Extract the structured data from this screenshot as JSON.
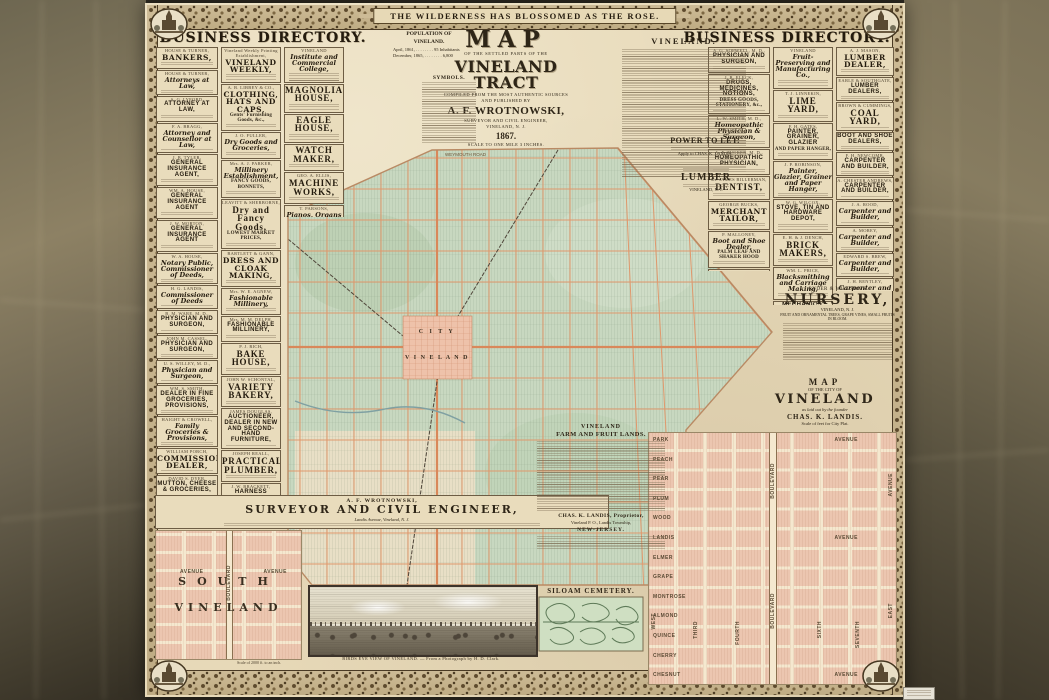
{
  "colors": {
    "parchment": "#e7d9b8",
    "map_green": "#c8d8c0",
    "road_orange": "#e0986c",
    "plat_pink": "#ecc6b0",
    "frame_brown": "#5d4a2d",
    "background": "#6b6350"
  },
  "poster": {
    "banner": "THE WILDERNESS HAS BLOSSOMED AS THE ROSE.",
    "left_header": "BUSINESS DIRECTORY.",
    "right_header": "BUSINESS DIRECTORY."
  },
  "title_block": {
    "t1": "MAP",
    "t2": "OF THE SETTLED PARTS OF THE",
    "t3": "VINELAND TRACT",
    "t4": "COMPILED FROM THE MOST AUTHENTIC SOURCES",
    "t5": "AND PUBLISHED BY",
    "t6": "A. F. WROTNOWSKI,",
    "t7": "SURVEYOR AND CIVIL ENGINEER,",
    "t8": "VINELAND, N. J.",
    "t9": "1867.",
    "t10": "SCALE TO ONE MILE 3 INCHES."
  },
  "population": {
    "head": "POPULATION OF VINELAND.",
    "line1": "April, 1861, . . . . . . . .  95 Inhabitants",
    "line2": "December, 1865, . . . . . . . .  6,800"
  },
  "symbols_head": "SYMBOLS.",
  "article_head": "VINELAND.",
  "power": {
    "head": "POWER TO LET.",
    "apply": "Apply to CHAS. K. LANDIS."
  },
  "lumber": {
    "head": "LUMBER",
    "place": "VINELAND, N. J."
  },
  "map_labels": {
    "road": "WEYMOUTH ROAD",
    "city1": "C I T Y",
    "city2": "V I N E L A N D"
  },
  "nursery": {
    "n": "RYDER & WILLSON'S",
    "h": "NURSERY,",
    "place": "VINELAND, N. J.",
    "line": "FRUIT AND ORNAMENTAL TREES, GRAPE VINES, SMALL FRUITS IN BLOOM."
  },
  "city_title": {
    "l1": "MAP",
    "l2": "OF THE CITY OF",
    "l3": "VINELAND",
    "l4": "as laid out by the founder",
    "l5": "CHAS. K. LANDIS.",
    "l6": "Scale of feet for City Plat."
  },
  "city_plat": {
    "cross_streets": [
      "PARK",
      "PEACH",
      "PEAR",
      "PLUM",
      "WOOD",
      "LANDIS",
      "ELMER",
      "GRAPE",
      "MONTROSE",
      "ALMOND",
      "QUINCE",
      "CHERRY",
      "CHESNUT"
    ],
    "avenue_word": "AVENUE",
    "numbered_streets": [
      "THIRD",
      "FOURTH",
      "SIXTH",
      "SEVENTH"
    ],
    "west": "WEST",
    "east": "EAST",
    "boulevard": "BOULEVARD",
    "avenue_vert": "AVENUE"
  },
  "surveyor": {
    "n": "A. F. WROTNOWSKI,",
    "h": "SURVEYOR AND CIVIL ENGINEER,",
    "line": "Landis Avenue, Vineland, N. J."
  },
  "south": {
    "big1": "SOUTH",
    "big2": "VINELAND",
    "boulevard": "BOULEVARD",
    "avenue": "AVENUE",
    "scale": "Scale of 2000 ft. to an inch."
  },
  "farm": {
    "h1": "VINELAND",
    "h2": "FARM AND FRUIT LANDS.",
    "p1": "CHAS. K. LANDIS, Proprietor,",
    "p2": "Vineland P. O., Landis Township,",
    "p3": "NEW-JERSEY."
  },
  "cemetery_head": "SILOAM CEMETERY.",
  "birdseye_caption": "BIRDS EYE VIEW OF VINELAND. — From a Photograph by H. D. Clark.",
  "directories": {
    "lcol1": [
      {
        "n": "HOUSE & TURNER,",
        "h": "BANKERS,",
        "v": 3,
        "s": 2
      },
      {
        "n": "HOUSE & TURNER,",
        "h": "Attorneys at Law,",
        "v": 2,
        "s": 1
      },
      {
        "n": "A. G. LYFORD,",
        "h": "ATTORNEY AT LAW,",
        "v": 5,
        "s": 2
      },
      {
        "n": "F. A. BRAGG,",
        "h": "Attorney and Counsellor at Law,",
        "v": 2,
        "s": 1
      },
      {
        "n": "J. B. TYLER,",
        "h": "GENERAL INSURANCE AGENT,",
        "v": 5,
        "s": 2
      },
      {
        "n": "WM. A. HOUSE,",
        "h": "GENERAL INSURANCE AGENT",
        "v": 5,
        "s": 2
      },
      {
        "n": "J. W. MORTON,",
        "h": "GENERAL INSURANCE AGENT",
        "v": 5,
        "s": 2
      },
      {
        "n": "W. A. HOUSE,",
        "h": "Notary Public, Commissioner of Deeds,",
        "v": 2,
        "s": 1
      },
      {
        "n": "H. G. LANDIS,",
        "h": "Commissioner of Deeds",
        "v": 2,
        "s": 1
      },
      {
        "n": "B. M. WARE, M. D.,",
        "h": "PHYSICIAN AND SURGEON,",
        "v": 5,
        "s": 1
      },
      {
        "n": "JOHN M. CASSEL,",
        "h": "PHYSICIAN AND SURGEON,",
        "v": 5,
        "s": 1
      },
      {
        "n": "U. S. WILLEY, M. D.,",
        "h": "Physician and Surgeon,",
        "v": 2,
        "s": 1
      },
      {
        "n": "WM. S. SMITH,",
        "h": "DEALER IN FINE GROCERIES, PROVISIONS,",
        "v": 5,
        "s": 1
      },
      {
        "n": "HAIGHT & CROWELL,",
        "h": "Family Groceries & Provisions,",
        "v": 2,
        "s": 1
      },
      {
        "n": "WILLIAM PORCH,",
        "h": "COMMISSION DEALER,",
        "v": 3,
        "s": 1
      },
      {
        "n": "DAVID S. DYER,",
        "h": "MUTTON, CHEESE & GROCERIES,",
        "v": 5,
        "s": 1
      },
      {
        "n": "BACHELDER & DYER,",
        "h": "CHOICE GROCERIES AND PROVISIONS,",
        "v": 5,
        "s": 1
      },
      {
        "n": "LELAND & PARSONS,",
        "h": "MECHANICS' HALL MARKET,",
        "v": 3,
        "s": 1
      },
      {
        "n": "H. H. SIMON,",
        "h": "GROCERIES, PRODUCE,",
        "h2": "AND PROVISIONS,",
        "v": 3,
        "s": 1
      },
      {
        "n": "ERIC A. SMITH,",
        "h": "Dry Goods, Groceries,",
        "v": 2,
        "s": 1
      },
      {
        "n": "HERBERT A. SMITH,",
        "h": "DRY GOODS, PROVISIONS,",
        "v": 5,
        "s": 1
      },
      {
        "n": "PEARSON B. STONE,",
        "h": "PURE CLARIFIED CIDER VINEGAR,",
        "v": 5,
        "s": 1
      },
      {
        "n": "G. W. BABCOCK,",
        "h": "WATCHES, CLOCKS AND JEWELRY,",
        "v": 5,
        "s": 1
      },
      {
        "n": "SMITH & REEVE,",
        "h": "MANUFACTURERS OF CIGARS,",
        "v": 5,
        "s": 1
      }
    ],
    "lcol2": [
      {
        "n": "Vineland Weekly Printing Establishment,",
        "h": "VINELAND WEEKLY,",
        "v": 3,
        "s": 3
      },
      {
        "n": "A. B. LIBBEY & CO.,",
        "h": "CLOTHING, HATS AND CAPS,",
        "h2": "Gents' Furnishing Goods, &c.,",
        "v": 3,
        "s": 2
      },
      {
        "n": "J. O. FULLER,",
        "h": "Dry Goods and Groceries,",
        "v": 2,
        "s": 2
      },
      {
        "n": "Mrs. A. J. PARKER,",
        "h": "Millinery Establishment,",
        "h2": "FANCY GOODS, BONNETS,",
        "v": 2,
        "s": 2
      },
      {
        "n": "LEAVITT & SHERBORNE,",
        "h": "Dry and Fancy Goods,",
        "h2": "LOWEST MARKET PRICES,",
        "v": 4,
        "s": 2
      },
      {
        "n": "BARTLETT & GANN,",
        "h": "DRESS AND CLOAK MAKING,",
        "v": 3,
        "s": 2
      },
      {
        "n": "Mrs. W. E. AGNEW,",
        "h": "Fashionable Millinery,",
        "v": 2,
        "s": 2
      },
      {
        "n": "Mrs. M. M. DELPH,",
        "h": "FASHIONABLE MILLINERY,",
        "v": 5,
        "s": 2
      },
      {
        "n": "P. J. RICH,",
        "h": "BAKE HOUSE,",
        "v": 4,
        "s": 2
      },
      {
        "n": "JOHN W. SCHONTAL,",
        "h": "VARIETY BAKERY,",
        "v": 4,
        "s": 2
      },
      {
        "n": "JAMES DOUGLAS,",
        "h": "AUCTIONEER, DEALER IN NEW AND SECOND-HAND FURNITURE,",
        "v": 5,
        "s": 1
      },
      {
        "n": "JOSEPH REALL,",
        "h": "PRACTICAL PLUMBER,",
        "v": 4,
        "s": 2
      },
      {
        "n": "J. W. BRACKETT,",
        "h": "HARNESS MAKER & CARRIAGE TRIMMER,",
        "v": 5,
        "s": 1
      },
      {
        "n": "GEORGE S. BARING,",
        "h": "Horse Shoers and Carriage Smiths,",
        "v": 2,
        "s": 1
      },
      {
        "n": "LEWIS EDLIN,",
        "h": "Blacksmith and Carriage Work,",
        "v": 2,
        "s": 1
      },
      {
        "n": "THOMAS SHARP,",
        "h": "WELL DIGGER,",
        "v": 3,
        "s": 1
      },
      {
        "n": "D. E. POAGE,",
        "h": "FURNITURE AND JOB WAGON,",
        "v": 5,
        "s": 1
      },
      {
        "n": "DAVID HITCHNER,",
        "h": "Manufacturer of Rag Carpets,",
        "v": 2,
        "s": 1
      },
      {
        "n": "R. T. CUMMINGS,",
        "h": "Hair Cutting, Dyeing and Shaving,",
        "v": 2,
        "s": 1
      },
      {
        "n": "G. G. BROWNMAN,",
        "h": "BOOKS, STATIONERY, WALL PAPER, WINDOW SHADES, &c.,",
        "v": 5,
        "s": 1
      }
    ],
    "lcol3": [
      {
        "n": "VINELAND",
        "h": "Institute and Commercial College,",
        "v": 2,
        "s": 3
      },
      {
        "h": "MAGNOLIA HOUSE,",
        "v": 4,
        "s": 3
      },
      {
        "h": "EAGLE HOUSE,",
        "v": 4,
        "s": 3
      },
      {
        "h": "WATCH MAKER,",
        "v": 4,
        "s": 2
      },
      {
        "n": "GEO. A. ELLIS,",
        "h": "MACHINE WORKS,",
        "v": 4,
        "s": 2
      },
      {
        "n": "T. PARSONS,",
        "h": "Pianos, Organs and Melodeons,",
        "v": 2,
        "s": 2
      },
      {
        "h": "MERCHANT TAILOR,",
        "v": 3,
        "s": 2
      }
    ],
    "rcol1": [
      {
        "n": "A. G. SOPWELL, M. D.,",
        "h": "PHYSICIAN AND SURGEON,",
        "v": 5,
        "s": 2
      },
      {
        "n": "J. R. ELECK,",
        "h": "DRUGS, MEDICINES, NOTIONS,",
        "h2": "DRESS GOODS, STATIONERY, &c.,",
        "v": 5,
        "s": 1
      },
      {
        "n": "L. W. SMITH, M. D.,",
        "h": "Homeopathic Physician & Surgeon,",
        "v": 2,
        "s": 2
      },
      {
        "n": "A. F. TUCKER, M. D.,",
        "h": "HOMEOPATHIC PHYSICIAN,",
        "v": 5,
        "s": 2
      },
      {
        "n": "Dr. JAMES BILLERMAN,",
        "h": "DENTIST,",
        "v": 4,
        "s": 2
      },
      {
        "n": "GEORGE BUCKS,",
        "h": "MERCHANT TAILOR,",
        "v": 3,
        "s": 2
      },
      {
        "n": "P. MALLONEY,",
        "h": "Boot and Shoe Dealer,",
        "h2": "PALM LEAF AND SHAKER HOOD",
        "v": 2,
        "s": 2
      },
      {
        "n": "H. D. CLARK,",
        "h": "PHOTOGRAPHER,",
        "h2": "Post Office Building,",
        "v": 4,
        "s": 2
      },
      {
        "h": "TOWN TALKS,",
        "v": 5,
        "s": 3
      }
    ],
    "rcol2": [
      {
        "n": "VINELAND",
        "h": "Fruit-Preserving and Manufacturing Co.,",
        "v": 2,
        "s": 3
      },
      {
        "n": "T. J. LINNEKIN,",
        "h": "LIME YARD,",
        "v": 4,
        "s": 2
      },
      {
        "n": "F. H. GATES,",
        "h": "PAINTER, GRAINER, GLAZIER",
        "h2": "AND PAPER HANGER,",
        "v": 5,
        "s": 2
      },
      {
        "n": "J. P. ROBINSON,",
        "h": "Painter, Glazier, Grainer and Paper Hanger,",
        "v": 2,
        "s": 1
      },
      {
        "n": "W. G. WILCOX,",
        "h": "STOVE, TIN AND HARDWARE DEPOT,",
        "v": 5,
        "s": 3
      },
      {
        "n": "E. H. & J. DENCH,",
        "h": "BRICK MAKERS,",
        "v": 4,
        "s": 2
      },
      {
        "n": "WM. L. PRICE,",
        "h": "Blacksmithing and Carriage Making,",
        "v": 2,
        "s": 2
      },
      {
        "h": "MECHANICS' HALL,",
        "v": 5,
        "s": 2
      },
      {
        "n": "GASTON & HANN,",
        "h": "Livery and Sale Stables,",
        "v": 2,
        "s": 2
      },
      {
        "h": "LIVERY, SALE AND EXCHANGE STABLES,",
        "v": 5,
        "s": 1
      }
    ],
    "rcol3": [
      {
        "n": "A. J. MASON,",
        "h": "LUMBER DEALER,",
        "v": 3,
        "s": 2
      },
      {
        "n": "EARLE & SOUTHGATE,",
        "h": "LUMBER DEALERS,",
        "v": 5,
        "s": 1
      },
      {
        "n": "BROWN & CUMMINGS,",
        "h": "COAL YARD,",
        "v": 4,
        "s": 1
      },
      {
        "h": "BOOT AND SHOE DEALERS,",
        "v": 5,
        "s": 1
      },
      {
        "n": "F. H. NEWCOMB,",
        "h": "CARPENTER AND BUILDER,",
        "v": 5,
        "s": 1
      },
      {
        "n": "A. CHESTER ANDREWS,",
        "h": "CARPENTER AND BUILDER,",
        "v": 5,
        "s": 1
      },
      {
        "n": "J. A. ROOD,",
        "h": "Carpenter and Builder,",
        "v": 2,
        "s": 1
      },
      {
        "n": "A. MOREY,",
        "h": "Carpenter and Builder,",
        "v": 2,
        "s": 1
      },
      {
        "n": "EDWARD S. BREW,",
        "h": "Carpenter and Builder,",
        "v": 2,
        "s": 1
      },
      {
        "n": "J. H. BENTLEY,",
        "h": "Carpenter and Builder,",
        "v": 2,
        "s": 1
      },
      {
        "n": "J. G. HARRISON,",
        "h": "FRUIT TREES, VINES, SMALL FRUITS, &c.,",
        "v": 5,
        "s": 2
      },
      {
        "h": "Fruit and Ornamental Trees,",
        "h2": "Hardy Grape Vines, Small Fruits, &c.,",
        "v": 2,
        "s": 1
      }
    ]
  }
}
